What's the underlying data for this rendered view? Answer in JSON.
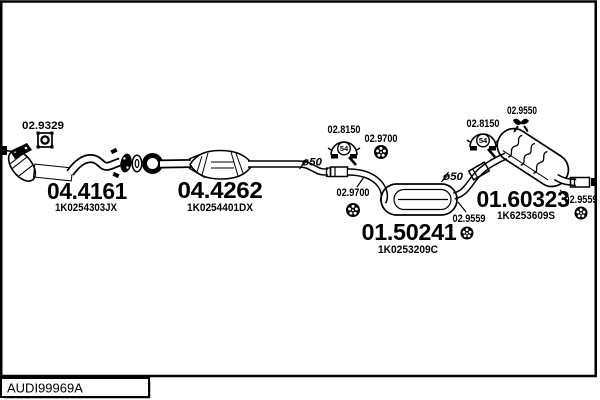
{
  "colors": {
    "line": "#000000",
    "background": "#ffffff"
  },
  "footer": {
    "drawing_code": "AUDI99969A"
  },
  "parts": {
    "front_pipe": {
      "code": "04.4161",
      "oem": "1K0254303JX"
    },
    "catalyst": {
      "code": "04.4262",
      "oem": "1K0254401DX"
    },
    "centre_muffler": {
      "code": "01.50241",
      "oem": "1K0253209C"
    },
    "rear_muffler": {
      "code": "01.60323",
      "oem": "1K6253609S"
    }
  },
  "accessories": {
    "gasket": {
      "code": "02.9329",
      "icon": "square-gasket-icon"
    },
    "clamp": {
      "code": "02.8150",
      "size": "54",
      "icon": "pipe-clamp-icon"
    },
    "mount_ring": {
      "code": "02.9700",
      "icon": "rubber-ring-icon"
    },
    "mount_ring_rear": {
      "code": "02.9559",
      "icon": "rubber-ring-icon"
    },
    "hanger": {
      "code": "02.9550",
      "icon": "rubber-hanger-icon"
    },
    "pipe_diameter": "ø50"
  }
}
